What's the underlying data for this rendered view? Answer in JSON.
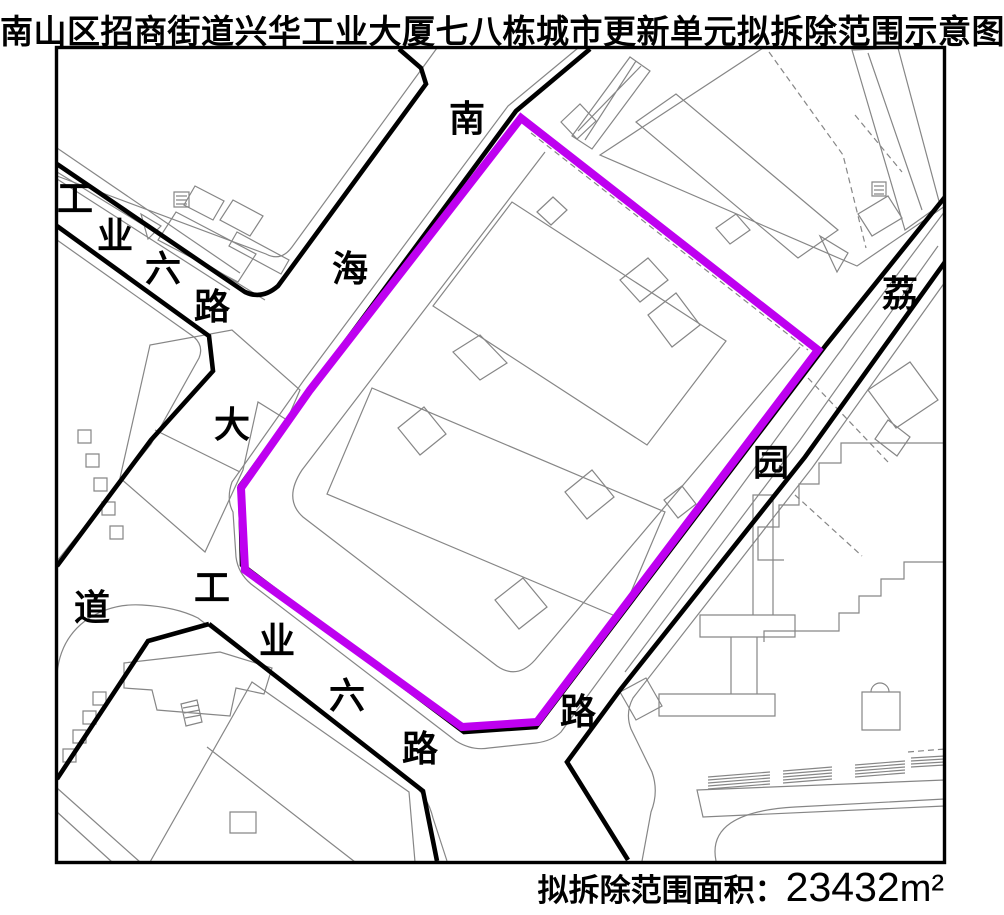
{
  "title": "南山区招商街道兴华工业大厦七八栋城市更新单元拟拆除范围示意图",
  "caption": {
    "label": "拟拆除范围面积：",
    "value": "23432",
    "unit": "m²"
  },
  "map": {
    "colors": {
      "boundary": "#be00f0",
      "road": "#000000",
      "parcel": "#868686",
      "background": "#ffffff"
    },
    "roads": {
      "nanhai": {
        "name": "南海大道",
        "chars": [
          "南",
          "海",
          "大",
          "道"
        ]
      },
      "gongye_west": {
        "name": "工业六路",
        "chars": [
          "工",
          "业",
          "六",
          "路"
        ]
      },
      "gongye_east": {
        "name": "工业六路",
        "chars": [
          "工",
          "业",
          "六",
          "路"
        ]
      },
      "liyuan": {
        "name": "荔园路",
        "chars": [
          "荔",
          "园",
          "路"
        ]
      }
    }
  }
}
